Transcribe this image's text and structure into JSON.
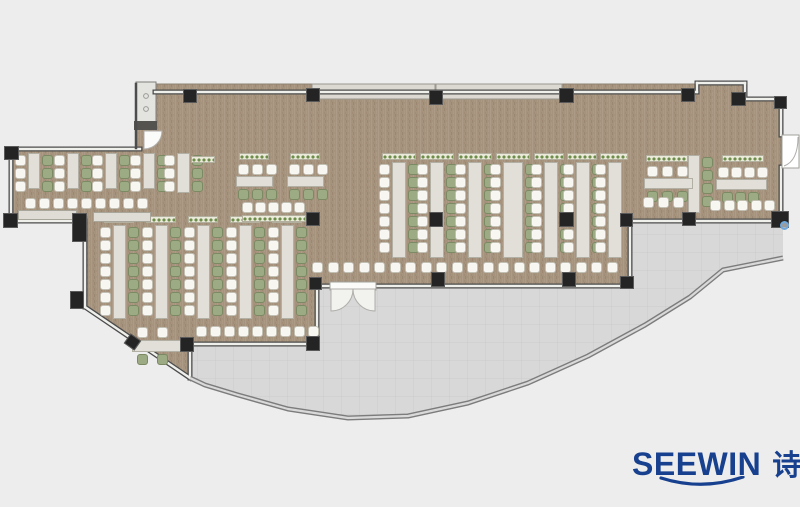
{
  "logo": {
    "latin": "SEEWIN",
    "cn": "诗敏"
  },
  "colors": {
    "background": "#ededed",
    "wood_floor": "#a6937d",
    "terrace": "#d8d8d8",
    "wall_dark": "#4c4c4c",
    "wall_light": "#efefec",
    "column": "#242424",
    "table": "#e1dfd7",
    "chair_white": "#f7f6f1",
    "chair_green": "#9dab84",
    "planter_green": "#6d8d4a",
    "logo_blue": "#17408f",
    "marker_blue": "#6fa8dc"
  },
  "floorplan": {
    "floor": [
      [
        136,
        84
      ],
      [
        697,
        84
      ],
      [
        697,
        81
      ],
      [
        746,
        81
      ],
      [
        746,
        99
      ],
      [
        781,
        99
      ],
      [
        781,
        221
      ],
      [
        630,
        221
      ],
      [
        630,
        286
      ],
      [
        317,
        286
      ],
      [
        317,
        344
      ],
      [
        190,
        344
      ],
      [
        190,
        379
      ],
      [
        85,
        308
      ],
      [
        85,
        221
      ],
      [
        10,
        221
      ],
      [
        10,
        148
      ],
      [
        136,
        148
      ]
    ],
    "terrace": [
      [
        190,
        344
      ],
      [
        317,
        344
      ],
      [
        317,
        286
      ],
      [
        630,
        286
      ],
      [
        630,
        221
      ],
      [
        783,
        221
      ],
      [
        783,
        258
      ],
      [
        723,
        270
      ],
      [
        690,
        297
      ],
      [
        645,
        325
      ],
      [
        588,
        356
      ],
      [
        528,
        383
      ],
      [
        468,
        403
      ],
      [
        408,
        416
      ],
      [
        348,
        418
      ],
      [
        288,
        409
      ],
      [
        238,
        395
      ],
      [
        205,
        385
      ],
      [
        190,
        378
      ]
    ],
    "curve": [
      [
        783,
        258
      ],
      [
        723,
        270
      ],
      [
        690,
        297
      ],
      [
        645,
        325
      ],
      [
        588,
        356
      ],
      [
        528,
        383
      ],
      [
        468,
        403
      ],
      [
        408,
        416
      ],
      [
        348,
        418
      ],
      [
        288,
        409
      ],
      [
        238,
        395
      ],
      [
        205,
        385
      ],
      [
        190,
        378
      ]
    ],
    "walls": [
      [
        155,
        92,
        697,
        92
      ],
      [
        697,
        83,
        697,
        92
      ],
      [
        697,
        83,
        745,
        83
      ],
      [
        745,
        83,
        745,
        99
      ],
      [
        745,
        99,
        781,
        99
      ],
      [
        781,
        99,
        781,
        135
      ],
      [
        781,
        167,
        781,
        221
      ],
      [
        11,
        149,
        140,
        149
      ],
      [
        11,
        149,
        11,
        221
      ],
      [
        11,
        221,
        85,
        221
      ],
      [
        85,
        221,
        85,
        307
      ],
      [
        85,
        307,
        190,
        378
      ],
      [
        190,
        344,
        190,
        378
      ],
      [
        190,
        344,
        317,
        344
      ],
      [
        317,
        286,
        317,
        344
      ],
      [
        317,
        286,
        331,
        286
      ],
      [
        374,
        286,
        630,
        286
      ],
      [
        630,
        221,
        630,
        286
      ],
      [
        630,
        221,
        783,
        221
      ]
    ],
    "solid_walls": [
      [
        136,
        84,
        136,
        148
      ]
    ],
    "ledges": [
      [
        312,
        84,
        123,
        15
      ],
      [
        436,
        84,
        126,
        15
      ]
    ],
    "elevator": {
      "box": [
        136,
        82,
        20,
        42
      ],
      "bar": [
        134,
        121,
        23,
        9
      ],
      "dots": [
        [
          146,
          96
        ],
        [
          146,
          109
        ]
      ]
    },
    "doors": {
      "double": {
        "lintel": [
          330,
          282,
          46,
          8
        ],
        "left_hinge": [
          331,
          289
        ],
        "right_hinge": [
          375,
          289
        ],
        "mid": [
          353,
          289
        ],
        "radius": 22
      },
      "right": {
        "rect": [
          782,
          135,
          17,
          33
        ]
      },
      "elevator_fan": {
        "hinge": [
          144,
          131
        ],
        "radius": 18
      }
    },
    "marker": [
      780,
      221
    ],
    "runs": [
      [
        34,
        153,
        36,
        3,
        12,
        "w",
        "g"
      ],
      [
        73,
        153,
        36,
        3,
        12,
        "w",
        "g"
      ],
      [
        111,
        153,
        36,
        3,
        12,
        "w",
        "g"
      ],
      [
        149,
        153,
        36,
        3,
        12,
        "w",
        "g"
      ],
      [
        183,
        153,
        40,
        3,
        13,
        "w",
        "g"
      ],
      [
        119,
        225,
        94,
        7,
        13,
        "w",
        "g"
      ],
      [
        161,
        225,
        94,
        7,
        13,
        "w",
        "g"
      ],
      [
        203,
        225,
        94,
        7,
        13,
        "w",
        "g"
      ],
      [
        245,
        225,
        94,
        7,
        13,
        "w",
        "g"
      ],
      [
        287,
        225,
        94,
        7,
        13,
        "w",
        "g"
      ],
      [
        399,
        162,
        96,
        7,
        14,
        "w",
        "g"
      ],
      [
        437,
        162,
        96,
        7,
        14,
        "w",
        "g"
      ],
      [
        475,
        162,
        96,
        7,
        14,
        "w",
        "g"
      ],
      [
        513,
        162,
        96,
        7,
        20,
        "w",
        "g"
      ],
      [
        551,
        162,
        96,
        7,
        14,
        "w",
        "g"
      ],
      [
        583,
        162,
        96,
        7,
        14,
        "w",
        "g"
      ],
      [
        615,
        162,
        96,
        7,
        14,
        "w",
        null
      ],
      [
        694,
        155,
        58,
        4,
        12,
        null,
        "g"
      ]
    ],
    "hgroups": [
      {
        "table": [
          236,
          176,
          37,
          11
        ],
        "above": {
          "y": 164,
          "xs": [
            238,
            252,
            266
          ],
          "c": "w"
        },
        "below": {
          "y": 189,
          "xs": [
            238,
            252,
            266
          ],
          "c": "g"
        }
      },
      {
        "table": [
          287,
          176,
          37,
          11
        ],
        "above": {
          "y": 164,
          "xs": [
            289,
            303,
            317
          ],
          "c": "w"
        },
        "below": {
          "y": 189,
          "xs": [
            289,
            303,
            317
          ],
          "c": "g"
        }
      },
      {
        "table": [
          644,
          178,
          49,
          11
        ],
        "above": {
          "y": 166,
          "xs": [
            647,
            662,
            677
          ],
          "c": "w"
        },
        "below": {
          "y": 191,
          "xs": [
            647,
            662,
            677
          ],
          "c": "g"
        }
      },
      {
        "table": [
          716,
          179,
          51,
          11
        ],
        "above": {
          "y": 167,
          "xs": [
            718,
            731,
            744,
            757
          ],
          "c": "w"
        },
        "below": {
          "y": 192,
          "xs": [
            722,
            735,
            748
          ],
          "c": "g"
        }
      },
      {
        "table": [
          132,
          340,
          51,
          12
        ],
        "above": {
          "y": 327,
          "xs": [
            137,
            157
          ],
          "c": "w"
        },
        "below": {
          "y": 354,
          "xs": [
            137,
            157
          ],
          "c": "g"
        }
      }
    ],
    "chair_rows": [
      [
        25,
        198,
        9,
        14,
        "w"
      ],
      [
        242,
        202,
        5,
        13,
        "w"
      ],
      [
        196,
        326,
        9,
        14,
        "w"
      ],
      [
        312,
        262,
        20,
        15.5,
        "w"
      ],
      [
        643,
        197,
        3,
        15,
        "w"
      ],
      [
        710,
        200,
        5,
        13.5,
        "w"
      ]
    ],
    "planters": [
      [
        104,
        216,
        30
      ],
      [
        146,
        216,
        30
      ],
      [
        188,
        216,
        30
      ],
      [
        230,
        216,
        30
      ],
      [
        272,
        216,
        30
      ],
      [
        382,
        153,
        34
      ],
      [
        420,
        153,
        34
      ],
      [
        458,
        153,
        34
      ],
      [
        496,
        153,
        34
      ],
      [
        534,
        153,
        30
      ],
      [
        567,
        153,
        30
      ],
      [
        600,
        153,
        28
      ],
      [
        239,
        153,
        30
      ],
      [
        290,
        153,
        30
      ],
      [
        242,
        215,
        64
      ],
      [
        191,
        156,
        24
      ],
      [
        646,
        155,
        42
      ],
      [
        722,
        155,
        42
      ]
    ],
    "benches": [
      [
        18,
        210,
        59,
        10
      ],
      [
        93,
        212,
        58,
        10
      ]
    ],
    "columns": [
      [
        183,
        89,
        14,
        14
      ],
      [
        306,
        88,
        14,
        14
      ],
      [
        429,
        90,
        14,
        15
      ],
      [
        559,
        88,
        15,
        15
      ],
      [
        681,
        88,
        14,
        14
      ],
      [
        731,
        92,
        15,
        14
      ],
      [
        774,
        96,
        13,
        13
      ],
      [
        4,
        146,
        15,
        14
      ],
      [
        3,
        213,
        15,
        15
      ],
      [
        72,
        213,
        15,
        29
      ],
      [
        306,
        212,
        14,
        14
      ],
      [
        429,
        212,
        14,
        15
      ],
      [
        559,
        212,
        15,
        15
      ],
      [
        620,
        213,
        13,
        14
      ],
      [
        682,
        212,
        14,
        14
      ],
      [
        771,
        211,
        18,
        17
      ],
      [
        309,
        277,
        13,
        13
      ],
      [
        431,
        272,
        14,
        15
      ],
      [
        562,
        272,
        14,
        15
      ],
      [
        620,
        276,
        14,
        13
      ],
      [
        180,
        337,
        14,
        15
      ],
      [
        306,
        336,
        14,
        15
      ],
      [
        70,
        291,
        14,
        18
      ],
      [
        126,
        336,
        13,
        12,
        35
      ]
    ]
  }
}
